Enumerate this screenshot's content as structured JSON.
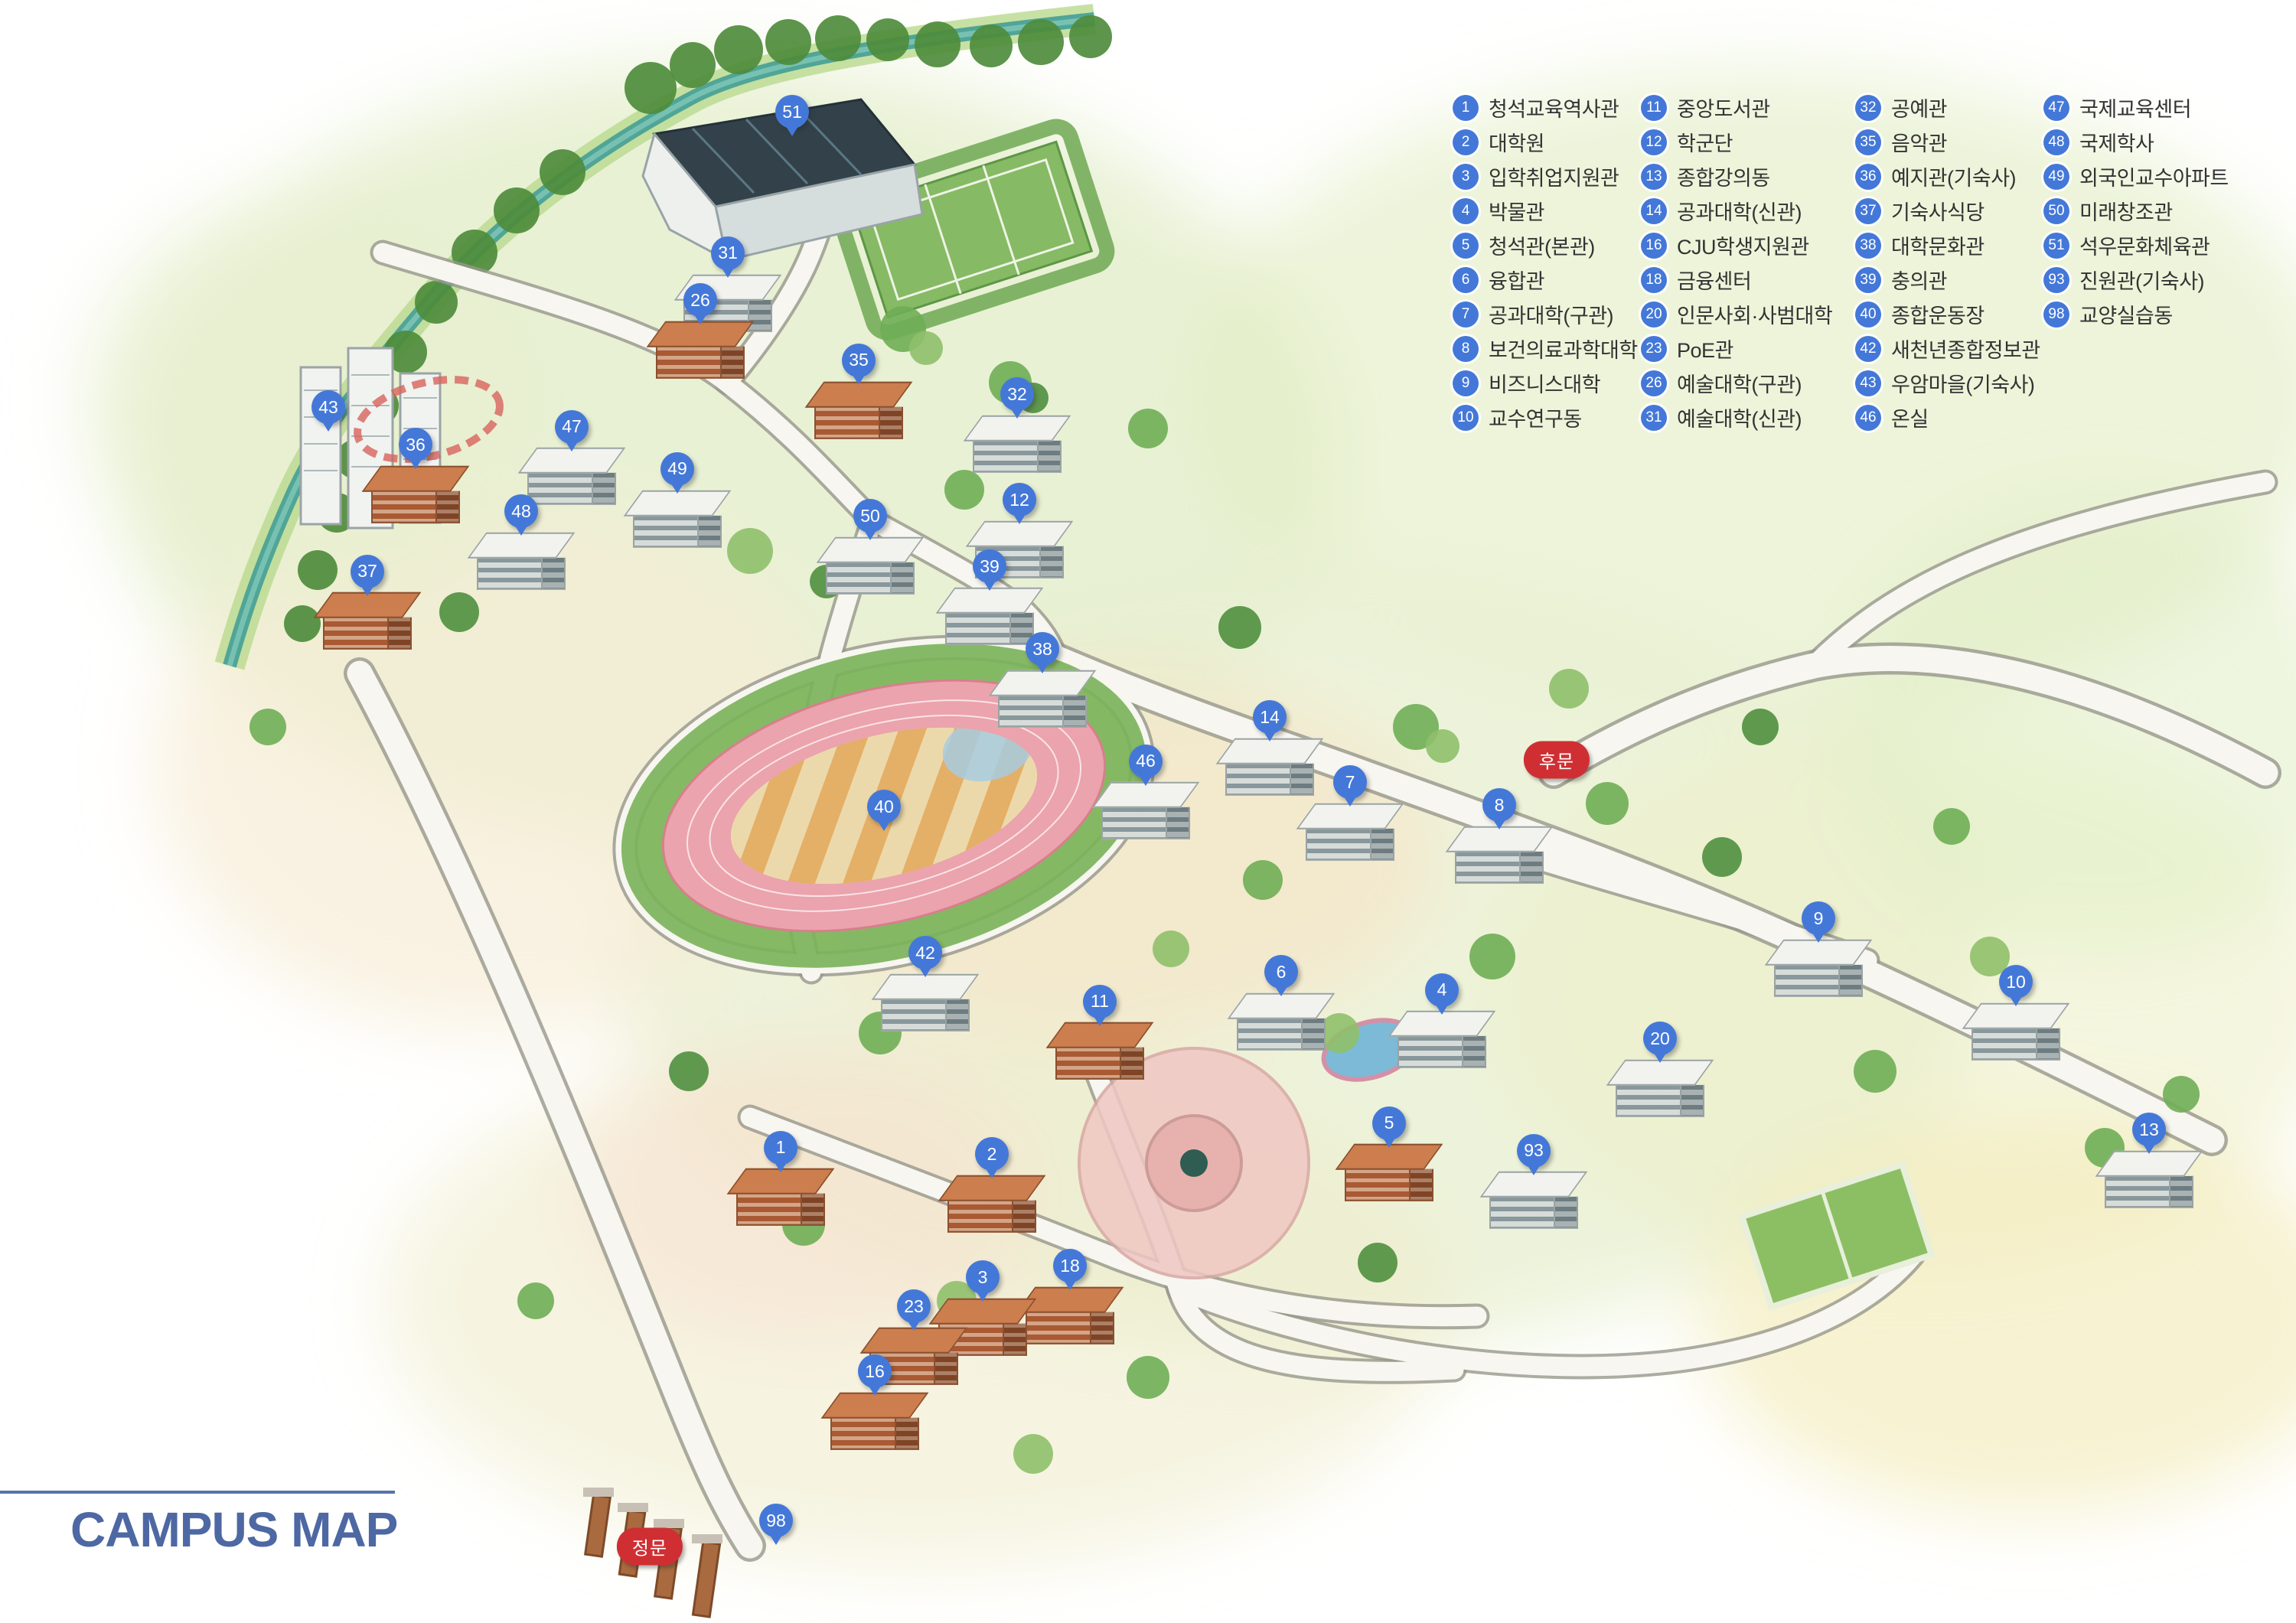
{
  "title": {
    "text": "CAMPUS MAP"
  },
  "colors": {
    "pin_blue": "#4478d8",
    "gate_red": "#cf2f33",
    "title_blue": "#4d68a3",
    "legend_text": "#333333",
    "river_teal": "#4aa296",
    "campus_wash_green": "#e4eec6"
  },
  "legend": {
    "columns": [
      {
        "items": [
          {
            "num": "1",
            "label": "청석교육역사관"
          },
          {
            "num": "2",
            "label": "대학원"
          },
          {
            "num": "3",
            "label": "입학취업지원관"
          },
          {
            "num": "4",
            "label": "박물관"
          },
          {
            "num": "5",
            "label": "청석관(본관)"
          },
          {
            "num": "6",
            "label": "융합관"
          },
          {
            "num": "7",
            "label": "공과대학(구관)"
          },
          {
            "num": "8",
            "label": "보건의료과학대학"
          },
          {
            "num": "9",
            "label": "비즈니스대학"
          },
          {
            "num": "10",
            "label": "교수연구동"
          }
        ]
      },
      {
        "items": [
          {
            "num": "11",
            "label": "중앙도서관"
          },
          {
            "num": "12",
            "label": "학군단"
          },
          {
            "num": "13",
            "label": "종합강의동"
          },
          {
            "num": "14",
            "label": "공과대학(신관)"
          },
          {
            "num": "16",
            "label": "CJU학생지원관"
          },
          {
            "num": "18",
            "label": "금융센터"
          },
          {
            "num": "20",
            "label": "인문사회·사범대학"
          },
          {
            "num": "23",
            "label": "PoE관"
          },
          {
            "num": "26",
            "label": "예술대학(구관)"
          },
          {
            "num": "31",
            "label": "예술대학(신관)"
          }
        ]
      },
      {
        "items": [
          {
            "num": "32",
            "label": "공예관"
          },
          {
            "num": "35",
            "label": "음악관"
          },
          {
            "num": "36",
            "label": "예지관(기숙사)"
          },
          {
            "num": "37",
            "label": "기숙사식당"
          },
          {
            "num": "38",
            "label": "대학문화관"
          },
          {
            "num": "39",
            "label": "충의관"
          },
          {
            "num": "40",
            "label": "종합운동장"
          },
          {
            "num": "42",
            "label": "새천년종합정보관"
          },
          {
            "num": "43",
            "label": "우암마을(기숙사)"
          },
          {
            "num": "46",
            "label": "온실"
          }
        ]
      },
      {
        "items": [
          {
            "num": "47",
            "label": "국제교육센터"
          },
          {
            "num": "48",
            "label": "국제학사"
          },
          {
            "num": "49",
            "label": "외국인교수아파트"
          },
          {
            "num": "50",
            "label": "미래창조관"
          },
          {
            "num": "51",
            "label": "석우문화체육관"
          },
          {
            "num": "93",
            "label": "진원관(기숙사)"
          },
          {
            "num": "98",
            "label": "교양실습동"
          }
        ]
      }
    ]
  },
  "markers": [
    {
      "num": "51",
      "x": 34.5,
      "y": 6.9,
      "building": "none"
    },
    {
      "num": "31",
      "x": 31.7,
      "y": 15.6,
      "building": "white"
    },
    {
      "num": "26",
      "x": 30.5,
      "y": 18.5,
      "building": "brick"
    },
    {
      "num": "35",
      "x": 37.4,
      "y": 22.2,
      "building": "brick"
    },
    {
      "num": "32",
      "x": 44.3,
      "y": 24.3,
      "building": "white"
    },
    {
      "num": "43",
      "x": 14.3,
      "y": 25.1,
      "building": "none"
    },
    {
      "num": "36",
      "x": 18.1,
      "y": 27.4,
      "building": "brick"
    },
    {
      "num": "47",
      "x": 24.9,
      "y": 26.3,
      "building": "white"
    },
    {
      "num": "49",
      "x": 29.5,
      "y": 28.9,
      "building": "white"
    },
    {
      "num": "48",
      "x": 22.7,
      "y": 31.5,
      "building": "white"
    },
    {
      "num": "37",
      "x": 16.0,
      "y": 35.2,
      "building": "brick"
    },
    {
      "num": "50",
      "x": 37.9,
      "y": 31.8,
      "building": "white"
    },
    {
      "num": "12",
      "x": 44.4,
      "y": 30.8,
      "building": "white"
    },
    {
      "num": "39",
      "x": 43.1,
      "y": 34.9,
      "building": "white"
    },
    {
      "num": "38",
      "x": 45.4,
      "y": 40.0,
      "building": "white"
    },
    {
      "num": "14",
      "x": 55.3,
      "y": 44.2,
      "building": "white"
    },
    {
      "num": "46",
      "x": 49.9,
      "y": 46.9,
      "building": "white"
    },
    {
      "num": "7",
      "x": 58.8,
      "y": 48.2,
      "building": "white"
    },
    {
      "num": "8",
      "x": 65.3,
      "y": 49.6,
      "building": "white"
    },
    {
      "num": "40",
      "x": 38.5,
      "y": 49.7,
      "building": "none"
    },
    {
      "num": "42",
      "x": 40.3,
      "y": 58.7,
      "building": "white"
    },
    {
      "num": "6",
      "x": 55.8,
      "y": 59.9,
      "building": "white"
    },
    {
      "num": "9",
      "x": 79.2,
      "y": 56.6,
      "building": "white"
    },
    {
      "num": "10",
      "x": 87.8,
      "y": 60.5,
      "building": "white"
    },
    {
      "num": "4",
      "x": 62.8,
      "y": 61.0,
      "building": "white"
    },
    {
      "num": "11",
      "x": 47.9,
      "y": 61.7,
      "building": "brick"
    },
    {
      "num": "20",
      "x": 72.3,
      "y": 64.0,
      "building": "white"
    },
    {
      "num": "5",
      "x": 60.5,
      "y": 69.2,
      "building": "brick"
    },
    {
      "num": "13",
      "x": 93.6,
      "y": 69.6,
      "building": "white"
    },
    {
      "num": "93",
      "x": 66.8,
      "y": 70.9,
      "building": "white"
    },
    {
      "num": "1",
      "x": 34.0,
      "y": 70.7,
      "building": "brick"
    },
    {
      "num": "2",
      "x": 43.2,
      "y": 71.1,
      "building": "brick"
    },
    {
      "num": "18",
      "x": 46.6,
      "y": 78.0,
      "building": "brick"
    },
    {
      "num": "3",
      "x": 42.8,
      "y": 78.7,
      "building": "brick"
    },
    {
      "num": "23",
      "x": 39.8,
      "y": 80.5,
      "building": "brick"
    },
    {
      "num": "16",
      "x": 38.1,
      "y": 84.5,
      "building": "brick"
    },
    {
      "num": "98",
      "x": 33.8,
      "y": 93.7,
      "building": "none"
    }
  ],
  "gates": [
    {
      "id": "back-gate",
      "label": "후문",
      "x": 67.8,
      "y": 46.8
    },
    {
      "id": "main-gate",
      "label": "정문",
      "x": 28.3,
      "y": 95.3
    }
  ]
}
